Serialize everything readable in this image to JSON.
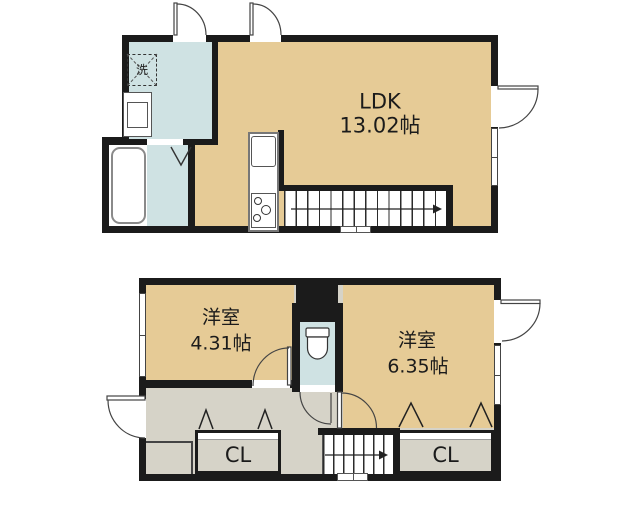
{
  "upper": {
    "ldk_label": "LDK",
    "ldk_size": "13.02帖",
    "washer_label": "洗"
  },
  "lower": {
    "bedroom_small_label": "洋室",
    "bedroom_small_size": "4.31帖",
    "bedroom_large_label": "洋室",
    "bedroom_large_size": "6.35帖",
    "closet_left_label": "CL",
    "closet_right_label": "CL"
  },
  "colors": {
    "wall": "#1b1b1b",
    "room": "#e6cb96",
    "wet": "#cfe2e3",
    "hall": "#d6d3c8",
    "background": "#ffffff"
  }
}
